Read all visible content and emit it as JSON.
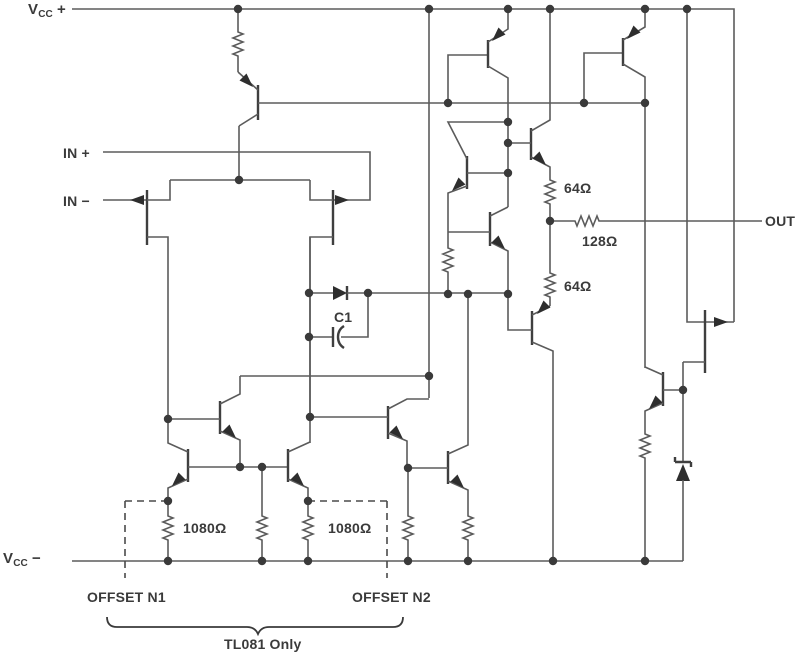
{
  "labels": {
    "vcc_plus": {
      "base": "V",
      "sub": "CC",
      "sign": "+"
    },
    "vcc_minus": {
      "base": "V",
      "sub": "CC",
      "sign": "−"
    },
    "in_plus": "IN +",
    "in_minus": "IN −",
    "out": "OUT",
    "c1": "C1",
    "r64_top": "64Ω",
    "r128": "128Ω",
    "r64_bot": "64Ω",
    "r1080_left": "1080Ω",
    "r1080_right": "1080Ω",
    "offset_n1": "OFFSET N1",
    "offset_n2": "OFFSET N2",
    "tl081_only": "TL081 Only"
  },
  "colors": {
    "wire": "#5b5b5b",
    "text": "#3a3a3a",
    "background": "#ffffff"
  }
}
